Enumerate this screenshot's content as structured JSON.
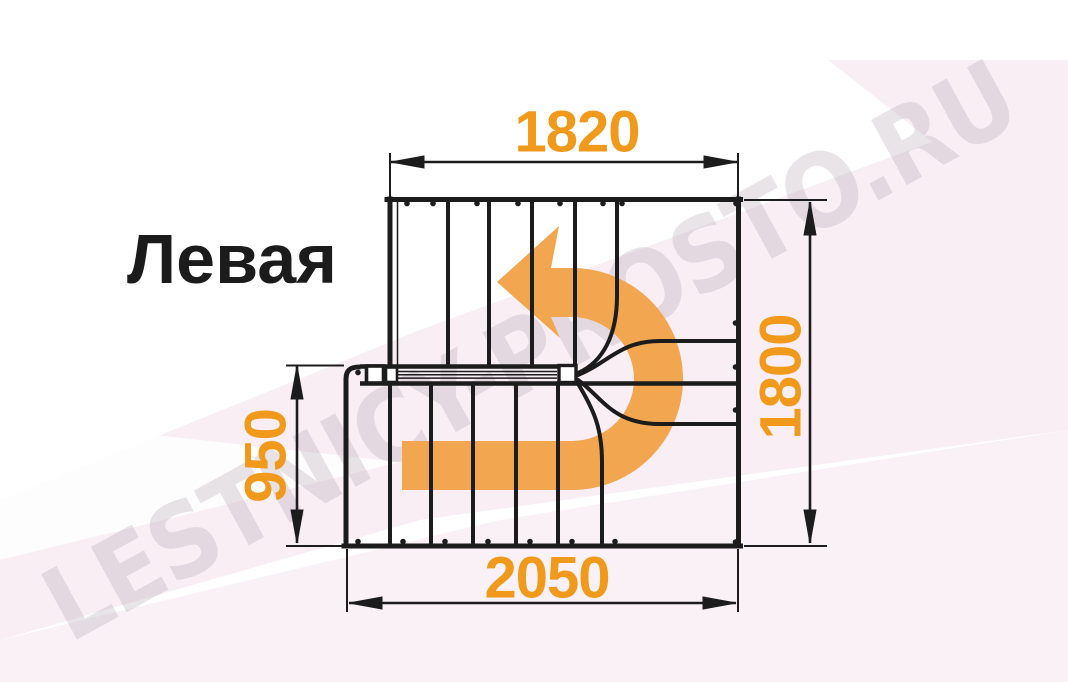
{
  "title": "Левая",
  "watermark": {
    "text": "LESTNICY-PROSTO.RU"
  },
  "plan": {
    "dimensions": {
      "top": "1820",
      "right": "1800",
      "left": "950",
      "bottom": "2050"
    }
  },
  "colors": {
    "dimension_text": "#F0991B",
    "direction_arrow": "#F1A64F",
    "plan_lines": "#1C1C1C",
    "background_tint": "#F8EEF4",
    "watermark_text": "#E5DEE3"
  }
}
